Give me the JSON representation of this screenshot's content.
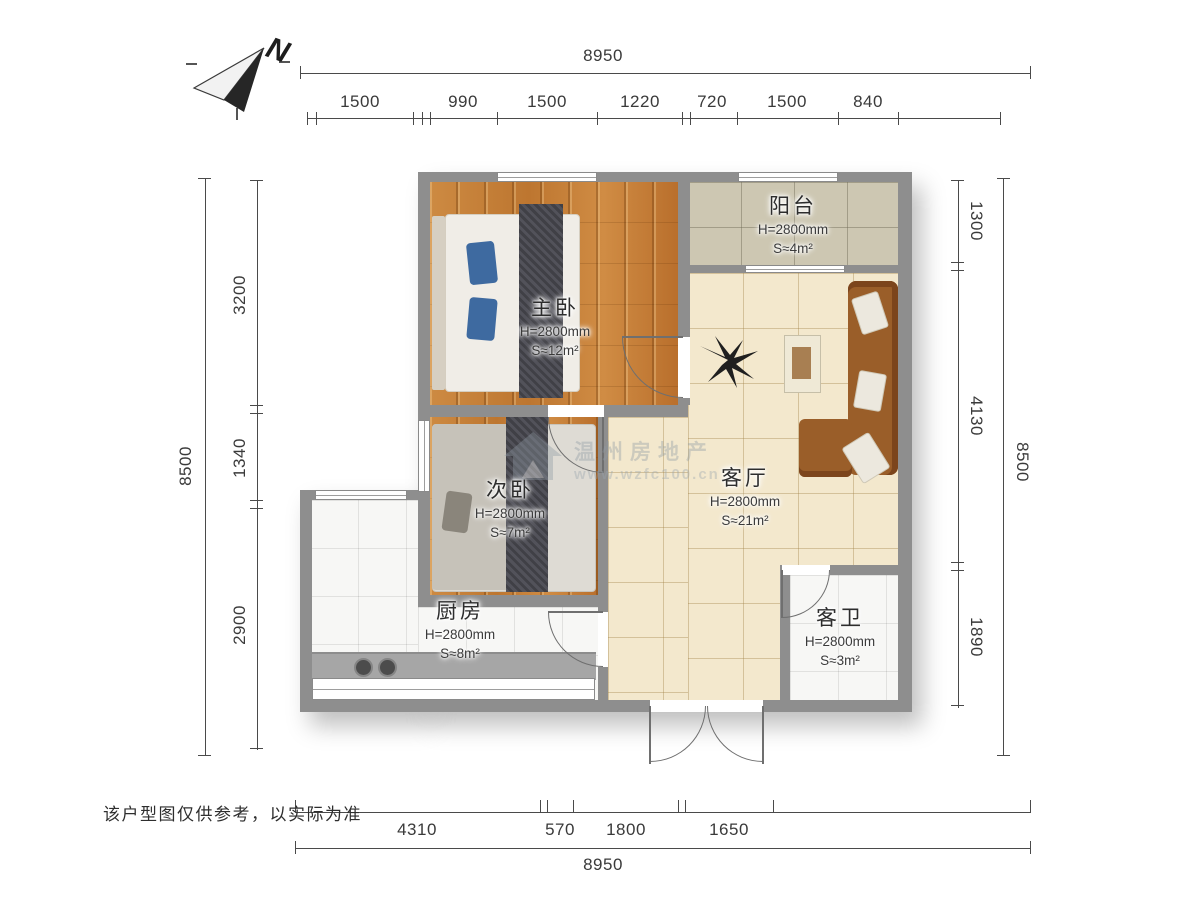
{
  "compass": {
    "label": "N"
  },
  "dimensions": {
    "top": {
      "total": "8950",
      "segments": [
        "1500",
        "990",
        "1500",
        "1220",
        "720",
        "1500",
        "840"
      ]
    },
    "bottom": {
      "total": "8950",
      "segments": [
        "4310",
        "570",
        "1800",
        "1650"
      ]
    },
    "left": {
      "total": "8500",
      "segments": [
        "3200",
        "1340",
        "2900"
      ]
    },
    "right": {
      "total": "8500",
      "segments": [
        "1300",
        "4130",
        "1890"
      ]
    }
  },
  "rooms": {
    "master": {
      "name": "主卧",
      "height": "H=2800mm",
      "area": "S≈12m²"
    },
    "balcony": {
      "name": "阳台",
      "height": "H=2800mm",
      "area": "S≈4m²"
    },
    "second": {
      "name": "次卧",
      "height": "H=2800mm",
      "area": "S≈7m²"
    },
    "living": {
      "name": "客厅",
      "height": "H=2800mm",
      "area": "S≈21m²"
    },
    "kitchen": {
      "name": "厨房",
      "height": "H=2800mm",
      "area": "S≈8m²"
    },
    "bathroom": {
      "name": "客卫",
      "height": "H=2800mm",
      "area": "S≈3m²"
    }
  },
  "watermark": {
    "line1": "温州房地产",
    "line2": "www.wzfc100.cn"
  },
  "disclaimer": "该户型图仅供参考，以实际为准",
  "colors": {
    "wall": "#8e8e8e",
    "wood": "#c5803a",
    "tile_living": "#f3e8cd",
    "tile_balcony": "#cdc7b2",
    "tile_white": "#f7f7f5",
    "sofa": "#9a5e29",
    "pillow_blue": "#3e6aa0",
    "runner": "#4a4a4e"
  }
}
